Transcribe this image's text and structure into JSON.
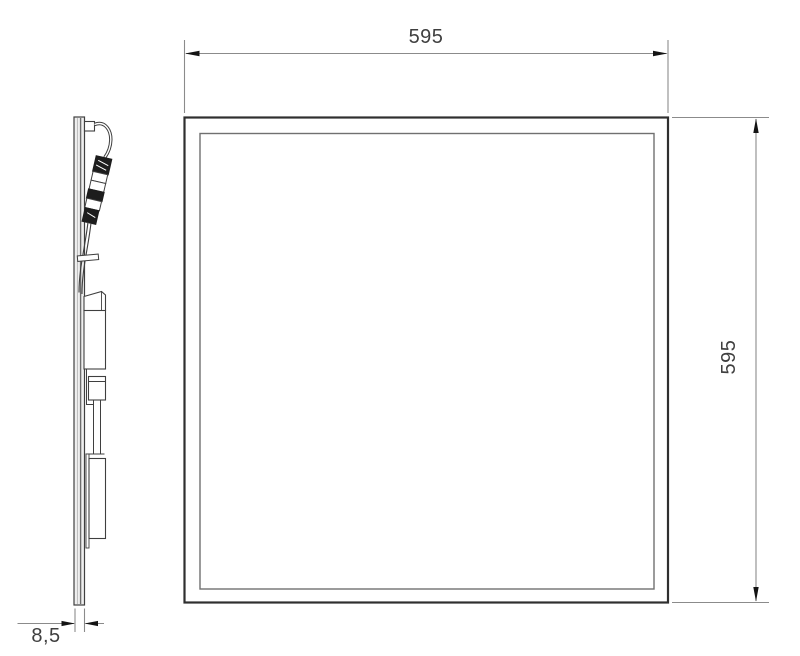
{
  "labels": {
    "width": "595",
    "height": "595",
    "thickness": "8,5"
  },
  "colors": {
    "panel_outline": "#2f2f2f",
    "inner_frame": "#707070",
    "side_view_lines": "#3f3f3f",
    "dimension_lines": "#8b8b8b",
    "arrowheads": "#141414",
    "dimension_text": "#3f3f3f",
    "background": "#ffffff"
  }
}
